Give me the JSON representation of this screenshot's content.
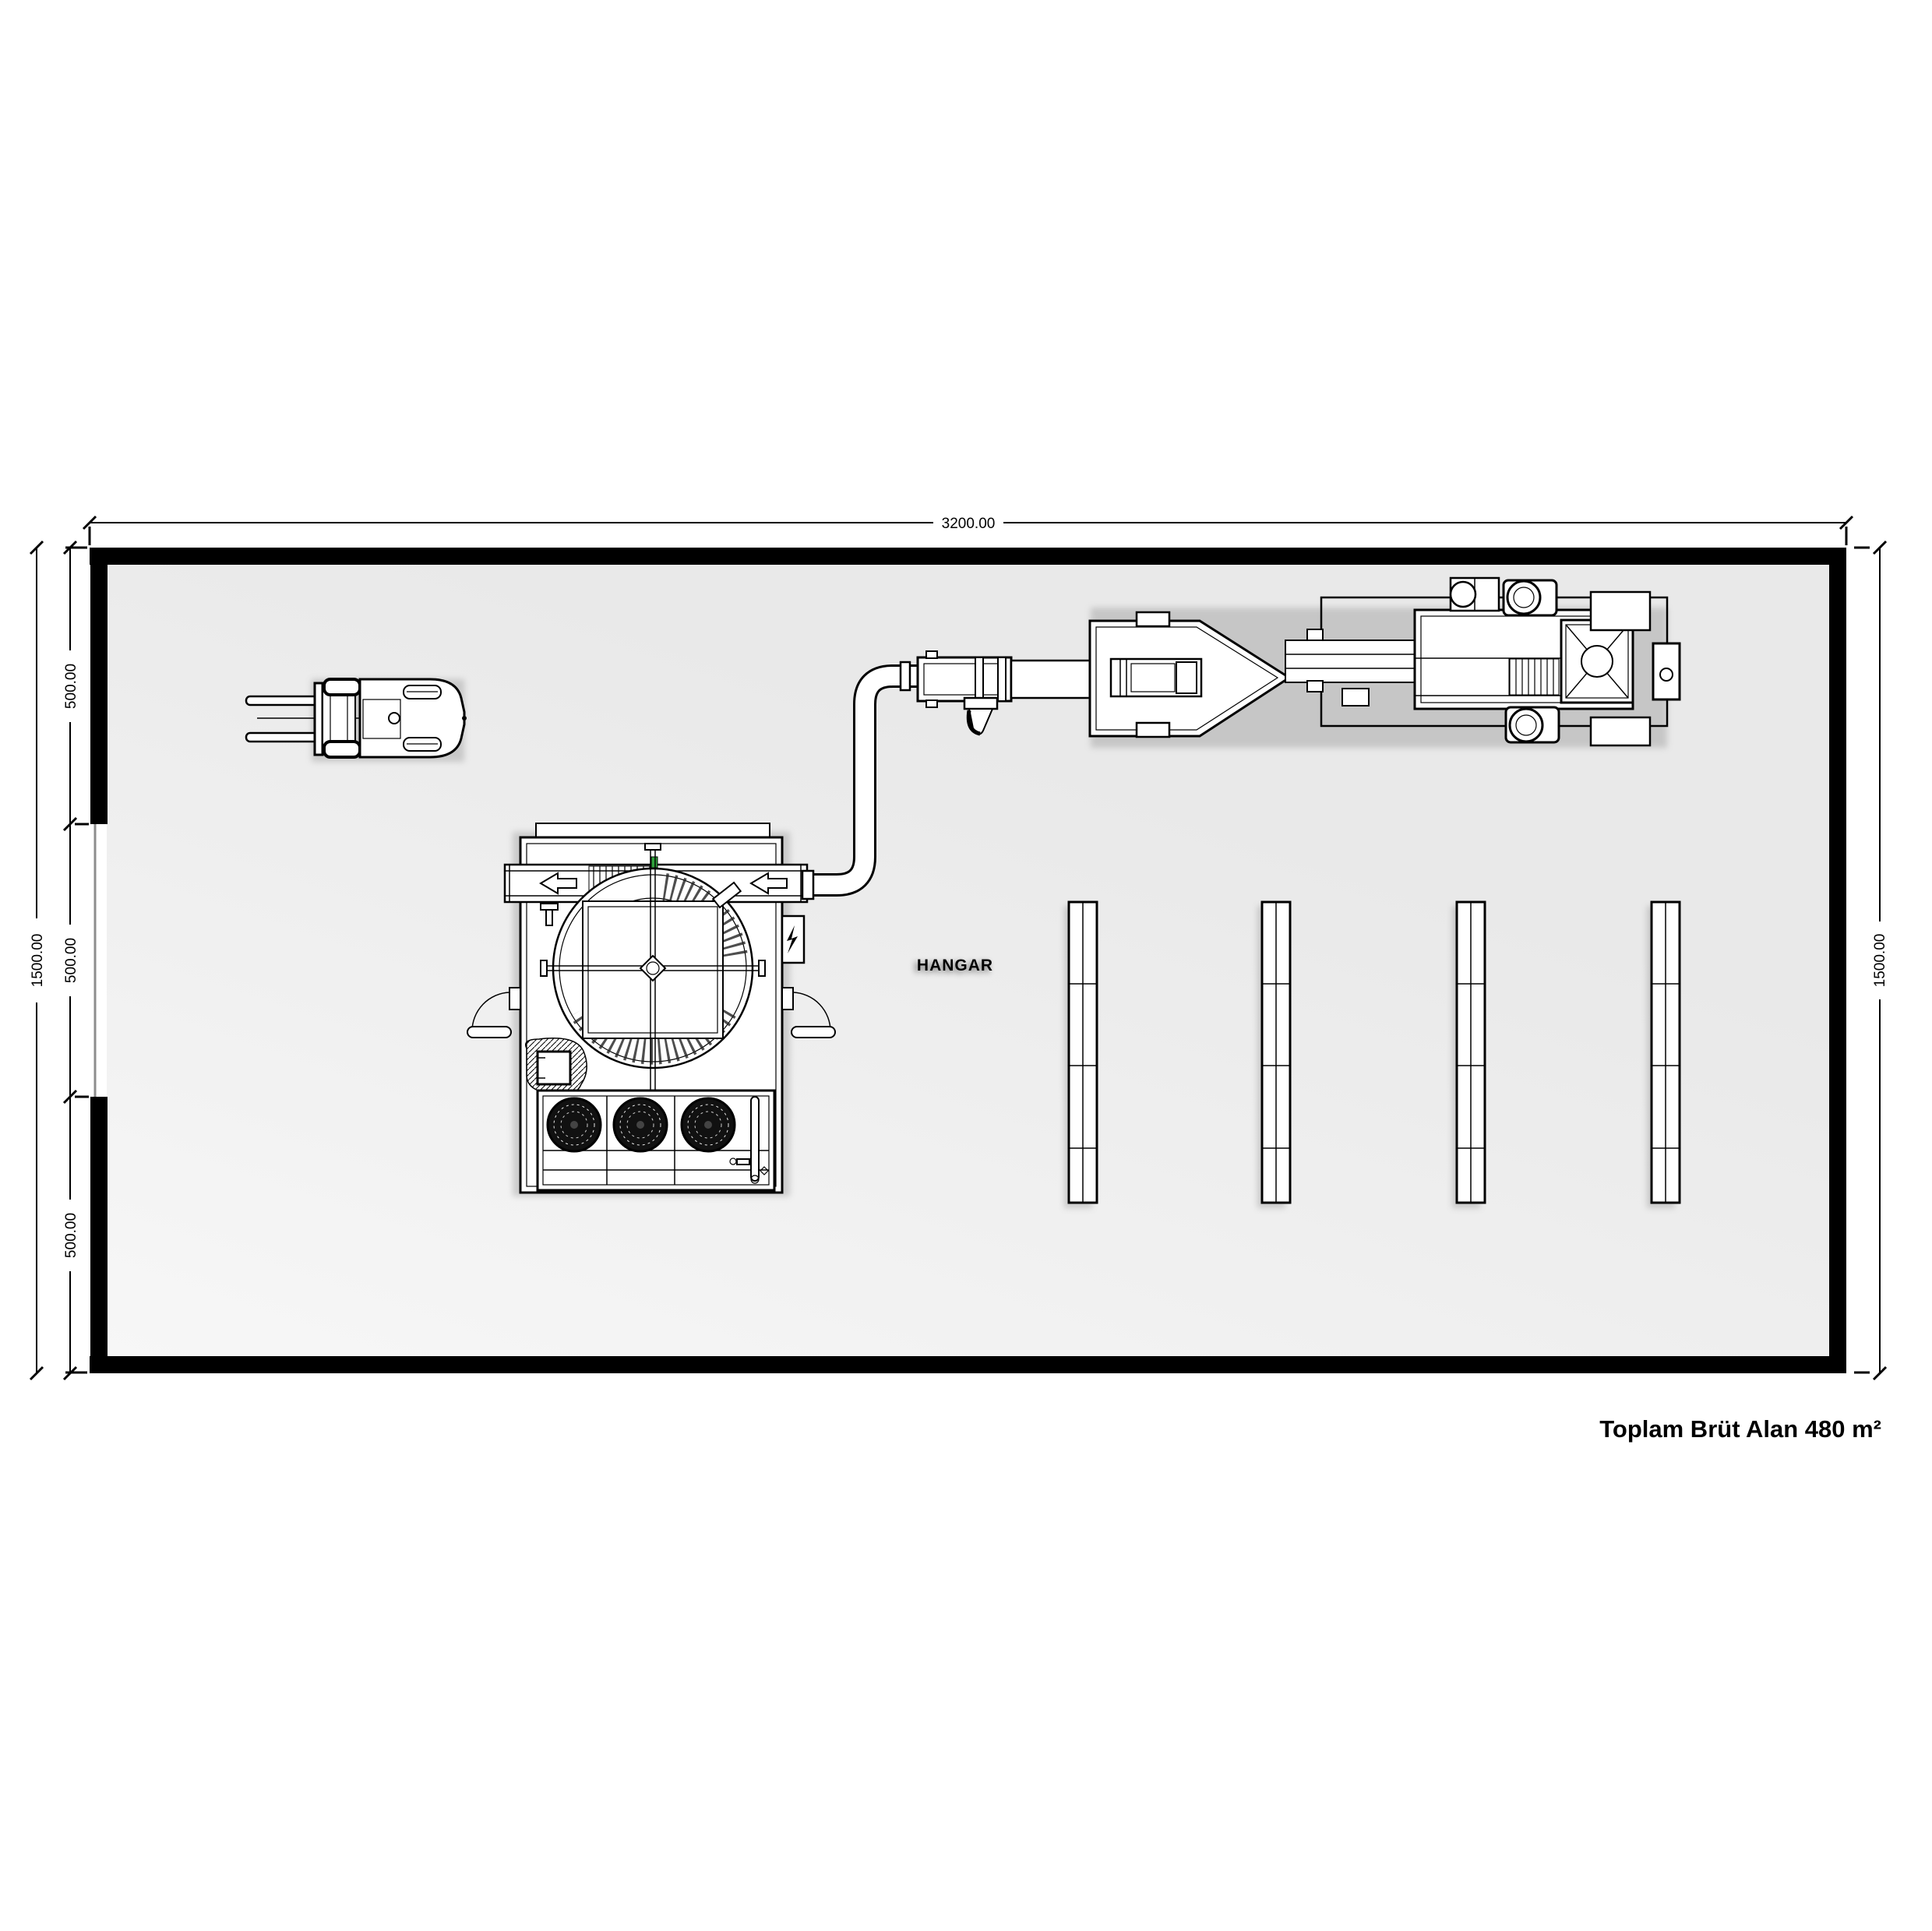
{
  "document": {
    "kind": "floor-plan",
    "room_label": "HANGAR",
    "area_label": "Toplam Brüt Alan 480 m²"
  },
  "dimensions": {
    "top_width": "3200.00",
    "left_total": "1500.00",
    "left_segments": [
      "500.00",
      "500.00",
      "500.00"
    ],
    "right_total": "1500.00"
  },
  "colors": {
    "background": "#ffffff",
    "wall": "#000000",
    "floor_light": "#f7f7f7",
    "floor_dark": "#e9e9e9",
    "line": "#000000",
    "accent_green": "#2fa33b",
    "fan_dark": "#111111"
  },
  "equipment": {
    "forklift": "forklift",
    "machine": "rotary-screening-machine",
    "fans": "triple-fan-bank",
    "pipe": "transfer-pipe",
    "boom": "boom-conveyor",
    "truck": "mobile-pump-truck",
    "racks": "storage-racks-x4"
  }
}
